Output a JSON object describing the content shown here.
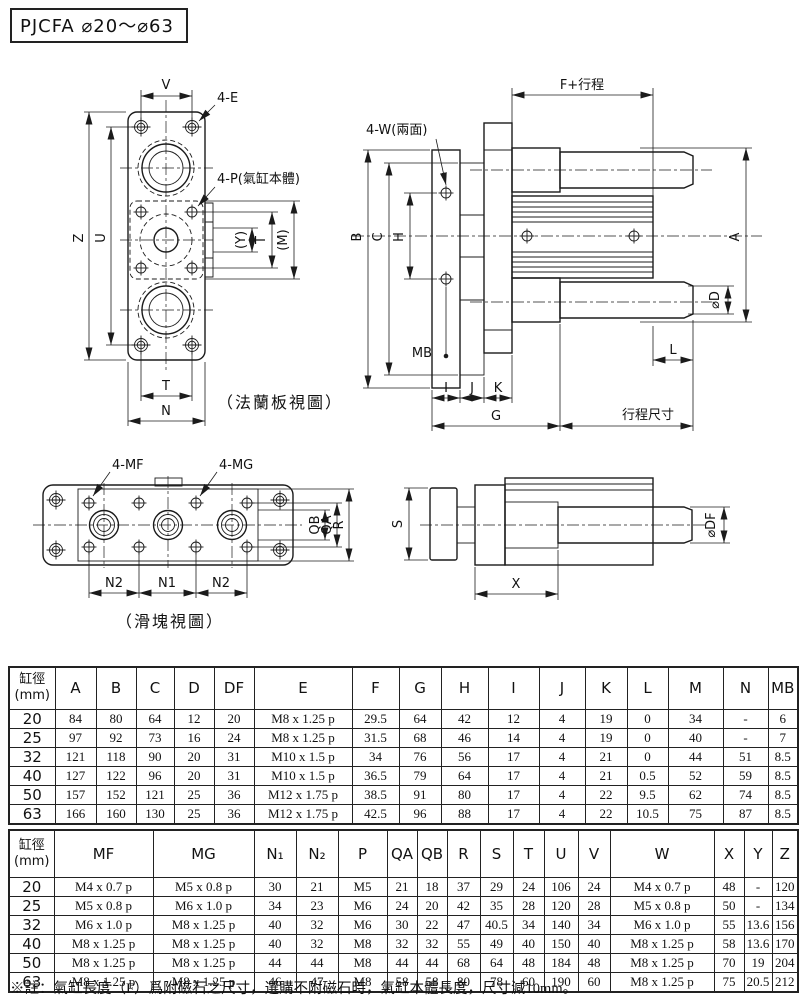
{
  "title": "PJCFA ⌀20～⌀63",
  "drawings": {
    "flange_view": {
      "caption": "（法蘭板視圖）",
      "dim_v": "V",
      "label_4e": "4-E",
      "label_4p": "4-P(氣缸本體)",
      "dim_z": "Z",
      "dim_u": "U",
      "dim_y": "(Y)",
      "dim_t_right": "T",
      "dim_m": "(M)",
      "dim_t_bottom": "T",
      "dim_n": "N"
    },
    "side_view": {
      "dim_f_stroke": "F+行程",
      "label_4w": "4-W(兩面)",
      "dim_b": "B",
      "dim_c": "C",
      "dim_h": "H",
      "dim_a": "A",
      "dim_d": "⌀D",
      "dim_mb": "MB",
      "dim_i": "I",
      "dim_j": "J",
      "dim_k": "K",
      "dim_g": "G",
      "dim_l": "L",
      "dim_stroke": "行程尺寸"
    },
    "slider_view": {
      "caption": "（滑塊視圖）",
      "label_4mf": "4-MF",
      "label_4mg": "4-MG",
      "dim_qb": "QB",
      "dim_qa": "QA",
      "dim_r": "R",
      "dim_n2_left": "N2",
      "dim_n1": "N1",
      "dim_n2_right": "N2"
    },
    "slider_side_view": {
      "dim_s": "S",
      "dim_df": "⌀DF",
      "dim_x": "X"
    }
  },
  "table1": {
    "bore_header_line1": "缸徑",
    "bore_header_line2": "(mm)",
    "columns": [
      "A",
      "B",
      "C",
      "D",
      "DF",
      "E",
      "F",
      "G",
      "H",
      "I",
      "J",
      "K",
      "L",
      "M",
      "N",
      "MB"
    ],
    "rows": [
      {
        "bore": "20",
        "values": [
          "84",
          "80",
          "64",
          "12",
          "20",
          "M8 x 1.25 p",
          "29.5",
          "64",
          "42",
          "12",
          "4",
          "19",
          "0",
          "34",
          "-",
          "6"
        ]
      },
      {
        "bore": "25",
        "values": [
          "97",
          "92",
          "73",
          "16",
          "24",
          "M8 x 1.25 p",
          "31.5",
          "68",
          "46",
          "14",
          "4",
          "19",
          "0",
          "40",
          "-",
          "7"
        ]
      },
      {
        "bore": "32",
        "values": [
          "121",
          "118",
          "90",
          "20",
          "31",
          "M10 x 1.5 p",
          "34",
          "76",
          "56",
          "17",
          "4",
          "21",
          "0",
          "44",
          "51",
          "8.5"
        ]
      },
      {
        "bore": "40",
        "values": [
          "127",
          "122",
          "96",
          "20",
          "31",
          "M10 x 1.5 p",
          "36.5",
          "79",
          "64",
          "17",
          "4",
          "21",
          "0.5",
          "52",
          "59",
          "8.5"
        ]
      },
      {
        "bore": "50",
        "values": [
          "157",
          "152",
          "121",
          "25",
          "36",
          "M12 x 1.75 p",
          "38.5",
          "91",
          "80",
          "17",
          "4",
          "22",
          "9.5",
          "62",
          "74",
          "8.5"
        ]
      },
      {
        "bore": "63",
        "values": [
          "166",
          "160",
          "130",
          "25",
          "36",
          "M12 x 1.75 p",
          "42.5",
          "96",
          "88",
          "17",
          "4",
          "22",
          "10.5",
          "75",
          "87",
          "8.5"
        ]
      }
    ]
  },
  "table2": {
    "bore_header_line1": "缸徑",
    "bore_header_line2": "(mm)",
    "columns": [
      "MF",
      "MG",
      "N₁",
      "N₂",
      "P",
      "QA",
      "QB",
      "R",
      "S",
      "T",
      "U",
      "V",
      "W",
      "X",
      "Y",
      "Z"
    ],
    "rows": [
      {
        "bore": "20",
        "values": [
          "M4 x 0.7 p",
          "M5 x 0.8 p",
          "30",
          "21",
          "M5",
          "21",
          "18",
          "37",
          "29",
          "24",
          "106",
          "24",
          "M4 x 0.7 p",
          "48",
          "-",
          "120"
        ]
      },
      {
        "bore": "25",
        "values": [
          "M5 x 0.8 p",
          "M6 x 1.0 p",
          "34",
          "23",
          "M6",
          "24",
          "20",
          "42",
          "35",
          "28",
          "120",
          "28",
          "M5 x 0.8 p",
          "50",
          "-",
          "134"
        ]
      },
      {
        "bore": "32",
        "values": [
          "M6 x 1.0 p",
          "M8 x 1.25 p",
          "40",
          "32",
          "M6",
          "30",
          "22",
          "47",
          "40.5",
          "34",
          "140",
          "34",
          "M6 x 1.0 p",
          "55",
          "13.6",
          "156"
        ]
      },
      {
        "bore": "40",
        "values": [
          "M8 x 1.25 p",
          "M8 x 1.25 p",
          "40",
          "32",
          "M8",
          "32",
          "32",
          "55",
          "49",
          "40",
          "150",
          "40",
          "M8 x 1.25 p",
          "58",
          "13.6",
          "170"
        ]
      },
      {
        "bore": "50",
        "values": [
          "M8 x 1.25 p",
          "M8 x 1.25 p",
          "44",
          "44",
          "M8",
          "44",
          "44",
          "68",
          "64",
          "48",
          "184",
          "48",
          "M8 x 1.25 p",
          "70",
          "19",
          "204"
        ]
      },
      {
        "bore": "63",
        "values": [
          "M8 x 1.25 p",
          "M8 x 1.25 p",
          "46",
          "47",
          "M8",
          "58",
          "58",
          "80",
          "78",
          "60",
          "190",
          "60",
          "M8 x 1.25 p",
          "75",
          "20.5",
          "212"
        ]
      }
    ]
  },
  "footnote": "※註：氣缸長度（F）爲附磁石之尺寸，選購不附磁石時，氣缸本體長度，尺寸減10mm。",
  "colors": {
    "line": "#1b1b1b",
    "text": "#111111",
    "background": "#ffffff"
  }
}
